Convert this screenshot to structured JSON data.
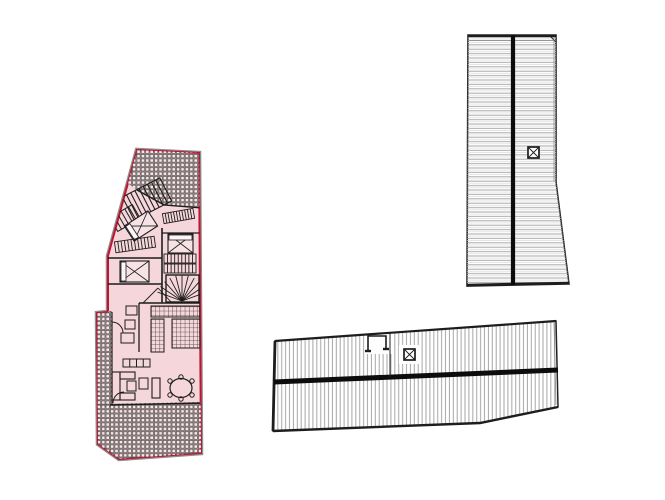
{
  "canvas": {
    "width": 665,
    "height": 500,
    "background": "#ffffff"
  },
  "palette": {
    "plan_fill": "#f5d7db",
    "plan_outline_red": "#c41230",
    "shadow_gray": "#8e8e8e",
    "ink": "#1d1d1d",
    "wall": "#2a2a2a",
    "roof_white": "#ffffff",
    "roof_outline": "#222222",
    "ridge_black": "#0c0c0c",
    "hatch_gray": "#a8a8a8",
    "inner_gray": "#8a8a8a"
  },
  "figures": [
    {
      "name": "floor-plan-highlighted",
      "clip": "planClip",
      "base": [
        {
          "t": "polygon",
          "name": "plan-shadow",
          "pts": "137,150 199,153 201,453 119,459 98,444 97,313 108,312 108,256",
          "f": "none",
          "s": "#8e8e8e",
          "sw": 4.5
        },
        {
          "t": "polygon",
          "name": "plan-outline",
          "pts": "137,150 199,153 201,453 119,459 98,444 97,313 108,312 108,256",
          "f": "#f5d7db",
          "s": "#c41230",
          "sw": 2
        }
      ],
      "detail": [
        {
          "t": "polygon",
          "name": "terrace-top",
          "pts": "110,148 202,150 202,208 164,205 137,190 110,170",
          "f": "url(#tiles)",
          "s": "none",
          "sw": 0
        },
        {
          "t": "rect",
          "name": "terrace-left-strip",
          "x": 96,
          "y": 311,
          "w": 16,
          "h": 96,
          "f": "url(#tiles)",
          "s": "none",
          "sw": 0
        },
        {
          "t": "polygon",
          "name": "terrace-bottom",
          "pts": "96,404 202,402 202,455 119,460 97,444",
          "f": "url(#tiles)",
          "s": "none",
          "sw": 0
        },
        {
          "t": "polyline",
          "name": "terrace-top-wall",
          "pts": "202,208 164,205 137,190",
          "sw": 1.4
        },
        {
          "t": "ladder",
          "name": "stair-upper",
          "x": 126,
          "y": 186,
          "w": 42,
          "h": 26,
          "rot": -27,
          "dir": "v",
          "n": 8,
          "sw": 1.1
        },
        {
          "t": "ladder",
          "name": "stair-upper-b",
          "x": 112,
          "y": 210,
          "w": 26,
          "h": 16,
          "rot": -30,
          "dir": "v",
          "n": 5,
          "sw": 1
        },
        {
          "t": "ladder",
          "name": "closet-a",
          "x": 163,
          "y": 211,
          "w": 31,
          "h": 10,
          "rot": -10,
          "dir": "v",
          "n": 10,
          "sw": 0.9
        },
        {
          "t": "bed",
          "name": "bed-rotated",
          "x": 127,
          "y": 217,
          "w": 28,
          "h": 18,
          "rot": -33,
          "pillow": "left"
        },
        {
          "t": "ladder",
          "name": "closet-b",
          "x": 115,
          "y": 239,
          "w": 40,
          "h": 11,
          "rot": -8,
          "dir": "v",
          "n": 11,
          "sw": 0.9
        },
        {
          "t": "bed",
          "name": "bed-right",
          "x": 168,
          "y": 234,
          "w": 25,
          "h": 19,
          "rot": 0,
          "pillow": "top"
        },
        {
          "t": "bed",
          "name": "bed-lower",
          "x": 120,
          "y": 261,
          "w": 29,
          "h": 21,
          "rot": 0,
          "pillow": "left"
        },
        {
          "t": "line",
          "name": "wall-core",
          "x1": 162,
          "y1": 228,
          "x2": 162,
          "y2": 303,
          "sw": 1.6
        },
        {
          "t": "line",
          "name": "wall-bedB-top",
          "x1": 162,
          "y1": 233,
          "x2": 202,
          "y2": 233,
          "sw": 1.3
        },
        {
          "t": "line",
          "name": "wall-mid-1",
          "x1": 108,
          "y1": 258,
          "x2": 162,
          "y2": 258,
          "sw": 1.4
        },
        {
          "t": "line",
          "name": "wall-mid-2",
          "x1": 108,
          "y1": 284,
          "x2": 162,
          "y2": 284,
          "sw": 1.4
        },
        {
          "t": "line",
          "name": "wall-kitchen-top",
          "x1": 139,
          "y1": 303,
          "x2": 202,
          "y2": 303,
          "sw": 1.6
        },
        {
          "t": "line",
          "name": "wall-kitchen-left",
          "x1": 139,
          "y1": 303,
          "x2": 139,
          "y2": 352,
          "sw": 1.3
        },
        {
          "t": "line",
          "name": "wall-living-bottom",
          "x1": 110,
          "y1": 405,
          "x2": 202,
          "y2": 403,
          "sw": 1.6
        },
        {
          "t": "line",
          "name": "wall-left-inner",
          "x1": 112,
          "y1": 312,
          "x2": 112,
          "y2": 405,
          "sw": 1.2
        },
        {
          "t": "ladder",
          "name": "stair-flight-1",
          "x": 164,
          "y": 254,
          "w": 32,
          "h": 9,
          "dir": "v",
          "n": 8,
          "sw": 0.9
        },
        {
          "t": "ladder",
          "name": "stair-flight-2",
          "x": 164,
          "y": 264,
          "w": 32,
          "h": 9,
          "dir": "v",
          "n": 8,
          "sw": 0.9
        },
        {
          "t": "rect",
          "name": "spiral-stair-box",
          "x": 166,
          "y": 275,
          "w": 33,
          "h": 27,
          "f": "none",
          "sw": 1.4
        },
        {
          "t": "fan",
          "name": "spiral-stair-fan",
          "cx": 182,
          "cy": 301,
          "r": 26,
          "a1": 20,
          "a2": 160,
          "n": 11,
          "sw": 0.9
        },
        {
          "t": "rect",
          "name": "kitchen-counter-top",
          "x": 151,
          "y": 306,
          "w": 49,
          "h": 11,
          "f": "url(#kgrid)",
          "sw": 1
        },
        {
          "t": "rect",
          "name": "kitchen-block-right",
          "x": 172,
          "y": 319,
          "w": 28,
          "h": 29,
          "f": "url(#kgrid)",
          "sw": 1
        },
        {
          "t": "rect",
          "name": "kitchen-column-left",
          "x": 151,
          "y": 319,
          "w": 13,
          "h": 33,
          "f": "url(#kgrid)",
          "sw": 1
        },
        {
          "t": "rect",
          "name": "fixture-1",
          "x": 126,
          "y": 306,
          "w": 11,
          "h": 9,
          "f": "none",
          "sw": 1
        },
        {
          "t": "rect",
          "name": "fixture-2",
          "x": 125,
          "y": 320,
          "w": 10,
          "h": 9,
          "f": "none",
          "sw": 1
        },
        {
          "t": "rect",
          "name": "fixture-3",
          "x": 121,
          "y": 333,
          "w": 13,
          "h": 10,
          "f": "none",
          "sw": 1
        },
        {
          "t": "line",
          "name": "hall-line-1",
          "x1": 143,
          "y1": 303,
          "x2": 158,
          "y2": 288,
          "sw": 0.9
        },
        {
          "t": "line",
          "name": "hall-line-2",
          "x1": 158,
          "y1": 288,
          "x2": 172,
          "y2": 303,
          "sw": 0.9
        },
        {
          "t": "path",
          "name": "door-arc-left",
          "d": "M 112 322 A 11 11 0 0 1 123 333",
          "f": "none",
          "sw": 1
        },
        {
          "t": "path",
          "name": "door-arc-terrace",
          "d": "M 113 403 A 11 11 0 0 1 124 392",
          "f": "none",
          "sw": 1
        },
        {
          "t": "rect",
          "name": "sofa-back",
          "x": 112,
          "y": 372,
          "w": 8,
          "h": 28,
          "f": "none",
          "sw": 1.1
        },
        {
          "t": "rect",
          "name": "sofa-arm-top",
          "x": 120,
          "y": 372,
          "w": 15,
          "h": 7,
          "f": "none",
          "sw": 1.1
        },
        {
          "t": "rect",
          "name": "sofa-arm-bottom",
          "x": 120,
          "y": 393,
          "w": 15,
          "h": 7,
          "f": "none",
          "sw": 1.1
        },
        {
          "t": "rect",
          "name": "coffee-table",
          "x": 127,
          "y": 381,
          "w": 9,
          "h": 10,
          "f": "none",
          "sw": 1
        },
        {
          "t": "rect",
          "name": "armchair",
          "x": 139,
          "y": 378,
          "w": 9,
          "h": 11,
          "f": "none",
          "sw": 1
        },
        {
          "t": "rect",
          "name": "tv-bench",
          "x": 152,
          "y": 378,
          "w": 8,
          "h": 20,
          "f": "none",
          "sw": 1.1
        },
        {
          "t": "ladder",
          "name": "sideboard",
          "x": 123,
          "y": 359,
          "w": 27,
          "h": 8,
          "dir": "v",
          "n": 3,
          "sw": 1
        },
        {
          "t": "ellipse",
          "name": "dining-table",
          "cx": 181,
          "cy": 388,
          "rx": 11,
          "ry": 9.5,
          "f": "none",
          "sw": 1.2
        },
        {
          "t": "circle",
          "name": "dining-chair",
          "cx": 170,
          "cy": 381,
          "r": 2.2,
          "f": "none",
          "sw": 1
        },
        {
          "t": "circle",
          "name": "dining-chair",
          "cx": 181,
          "cy": 377,
          "r": 2.2,
          "f": "none",
          "sw": 1
        },
        {
          "t": "circle",
          "name": "dining-chair",
          "cx": 192,
          "cy": 381,
          "r": 2.2,
          "f": "none",
          "sw": 1
        },
        {
          "t": "circle",
          "name": "dining-chair",
          "cx": 170,
          "cy": 395,
          "r": 2.2,
          "f": "none",
          "sw": 1
        },
        {
          "t": "circle",
          "name": "dining-chair",
          "cx": 181,
          "cy": 399,
          "r": 2.2,
          "f": "none",
          "sw": 1
        },
        {
          "t": "circle",
          "name": "dining-chair",
          "cx": 192,
          "cy": 395,
          "r": 2.2,
          "f": "none",
          "sw": 1
        }
      ]
    },
    {
      "name": "roof-plan-tower",
      "clip": null,
      "base": [
        {
          "t": "polygon",
          "name": "roof-tower-outline",
          "pts": "468,35 556,35 556,182 569,284 467,286",
          "f": "#ffffff",
          "s": "#222222",
          "sw": 1.6
        },
        {
          "t": "polygon",
          "name": "roof-tower-hatch",
          "pts": "468,35 556,35 556,182 569,284 467,286",
          "f": "url(#hatchH)",
          "s": "none",
          "sw": 0
        },
        {
          "t": "line",
          "name": "roof-tower-top-edge",
          "x1": 468,
          "y1": 36,
          "x2": 556,
          "y2": 36,
          "sw": 2.6
        },
        {
          "t": "line",
          "name": "roof-tower-top-inner",
          "x1": 469,
          "y1": 40.5,
          "x2": 555,
          "y2": 40.5,
          "s": "#8a8a8a",
          "sw": 0.8
        },
        {
          "t": "line",
          "name": "roof-tower-corner-mark",
          "x1": 549,
          "y1": 35,
          "x2": 556,
          "y2": 42,
          "sw": 1
        },
        {
          "t": "line",
          "name": "roof-tower-right-inner",
          "x1": 554,
          "y1": 37,
          "x2": 554,
          "y2": 181,
          "s": "#8a8a8a",
          "sw": 0.8
        },
        {
          "t": "line",
          "name": "roof-tower-bottom-edge",
          "x1": 467,
          "y1": 285,
          "x2": 569,
          "y2": 283,
          "sw": 2.6
        },
        {
          "t": "line",
          "name": "roof-tower-ridge",
          "x1": 513,
          "y1": 35,
          "x2": 513,
          "y2": 285,
          "s": "#0c0c0c",
          "sw": 4.2
        },
        {
          "t": "xrect",
          "name": "roof-tower-skylight",
          "x": 528,
          "y": 147,
          "w": 11,
          "h": 11,
          "sw": 1.7
        }
      ],
      "detail": []
    },
    {
      "name": "roof-plan-wing",
      "clip": null,
      "base": [
        {
          "t": "polygon",
          "name": "roof-wing-outline",
          "pts": "275,341 556,321 558,407 480,423 273,431",
          "f": "#ffffff",
          "s": "#222222",
          "sw": 1.5
        },
        {
          "t": "polygon",
          "name": "roof-wing-hatch",
          "pts": "275,341 556,321 558,407 480,423 273,431",
          "f": "url(#hatchV)",
          "s": "none",
          "sw": 0
        },
        {
          "t": "rect",
          "name": "chimney-clearing",
          "x": 366,
          "y": 330,
          "w": 26,
          "h": 24,
          "f": "#ffffff",
          "s": "none",
          "sw": 0
        },
        {
          "t": "rect",
          "name": "skylight-clearing",
          "x": 399,
          "y": 345,
          "w": 20,
          "h": 19,
          "f": "#ffffff",
          "s": "none",
          "sw": 0
        },
        {
          "t": "line",
          "name": "roof-wing-top-edge",
          "x1": 275,
          "y1": 341,
          "x2": 556,
          "y2": 321,
          "sw": 2.2
        },
        {
          "t": "line",
          "name": "roof-wing-left-edge",
          "x1": 275,
          "y1": 341,
          "x2": 273,
          "y2": 431,
          "sw": 2.8
        },
        {
          "t": "polyline",
          "name": "roof-wing-bottom-edge",
          "pts": "273,431 480,423 558,407",
          "sw": 2.4
        },
        {
          "t": "line",
          "name": "roof-wing-right-inner",
          "x1": 554,
          "y1": 323,
          "x2": 556,
          "y2": 405,
          "s": "#8a8a8a",
          "sw": 0.8
        },
        {
          "t": "line",
          "name": "roof-wing-ridge",
          "x1": 274,
          "y1": 382,
          "x2": 558,
          "y2": 370,
          "s": "#0c0c0c",
          "sw": 5
        },
        {
          "t": "polyline",
          "name": "chimney-outline",
          "pts": "368,351 368,336 386,336 386,349",
          "sw": 1.6
        },
        {
          "t": "line",
          "name": "chimney-foot-left",
          "x1": 365,
          "y1": 351,
          "x2": 371,
          "y2": 351,
          "sw": 2.4
        },
        {
          "t": "line",
          "name": "chimney-foot-right",
          "x1": 383,
          "y1": 349,
          "x2": 389,
          "y2": 349,
          "sw": 2.4
        },
        {
          "t": "line",
          "name": "roof-wing-divider",
          "x1": 390,
          "y1": 333,
          "x2": 390,
          "y2": 377,
          "sw": 1
        },
        {
          "t": "xrect",
          "name": "roof-wing-skylight",
          "x": 404,
          "y": 349,
          "w": 11,
          "h": 11,
          "sw": 1.7
        }
      ],
      "detail": []
    }
  ]
}
